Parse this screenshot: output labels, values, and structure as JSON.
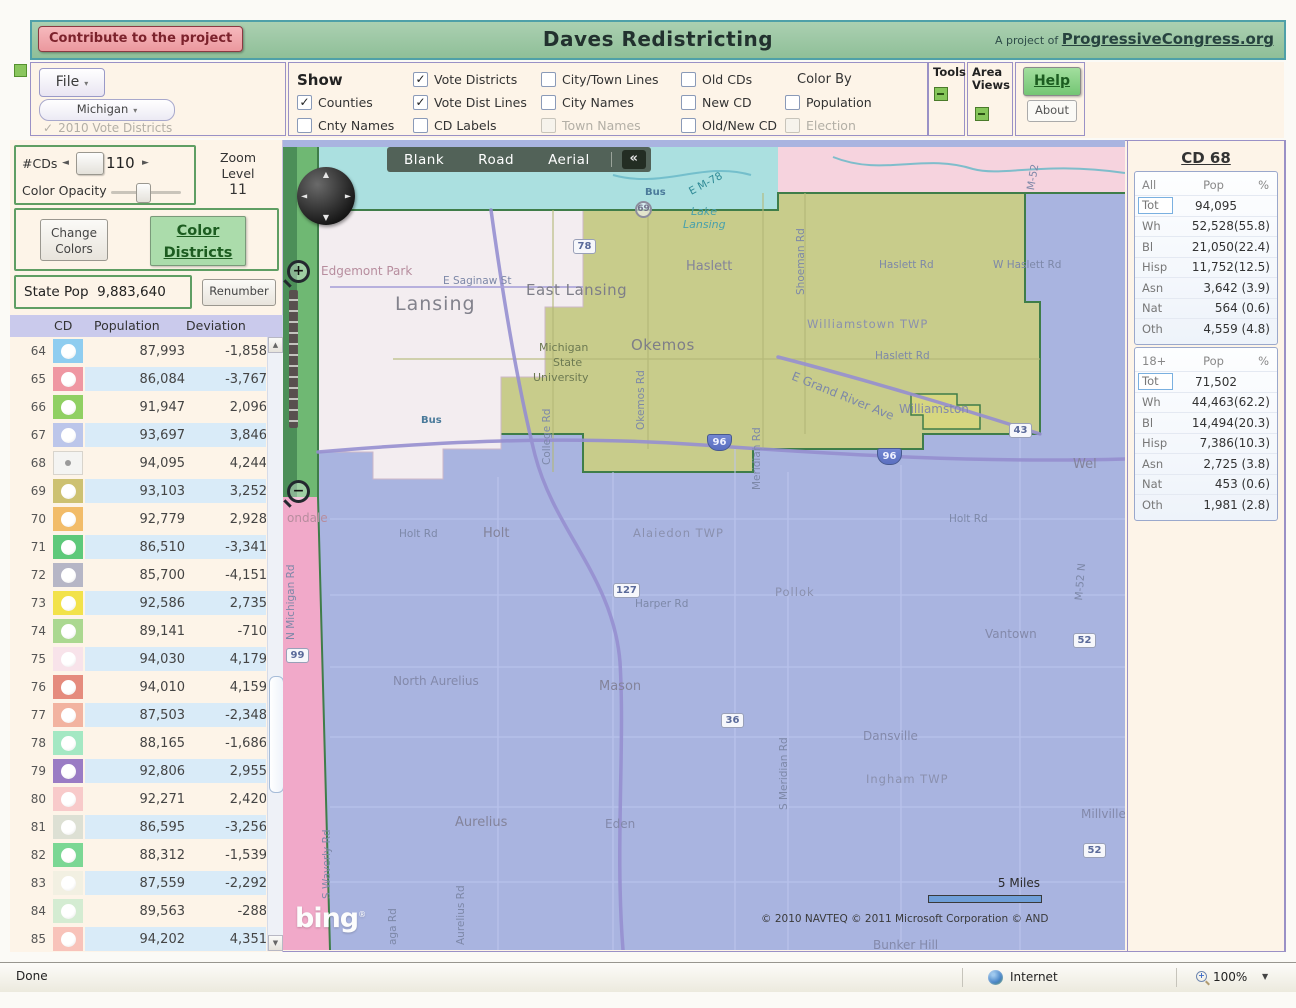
{
  "icons": {
    "caret_down": "▾",
    "check": "✓",
    "left_arrow": "◄",
    "right_arrow": "►",
    "up_arrow": "▲",
    "down_arrow": "▼",
    "collapse": "«",
    "compass_n": "▲",
    "compass_s": "▼",
    "compass_w": "◄",
    "compass_e": "►",
    "plus": "+",
    "minus": "−"
  },
  "banner": {
    "contribute_label": "Contribute to the project",
    "title": "Daves Redistricting",
    "project_prefix": "A project of",
    "project_link": "ProgressiveCongress.org"
  },
  "toolbar": {
    "file_label": "File",
    "state_label": "Michigan",
    "vote_districts_2010": "2010 Vote Districts",
    "show_columns": [
      {
        "header": "Show",
        "items": [
          {
            "label": "Counties",
            "checked": true
          },
          {
            "label": "Cnty Names"
          }
        ]
      },
      {
        "items": [
          {
            "label": "Vote Districts",
            "checked": true
          },
          {
            "label": "Vote Dist Lines",
            "checked": true
          },
          {
            "label": "CD Labels"
          }
        ]
      },
      {
        "items": [
          {
            "label": "City/Town Lines"
          },
          {
            "label": "City Names"
          },
          {
            "label": "Town Names",
            "disabled": true
          }
        ]
      },
      {
        "items": [
          {
            "label": "Old CDs"
          },
          {
            "label": "New CD"
          },
          {
            "label": "Old/New CD"
          }
        ]
      },
      {
        "header": "Color By",
        "header_plain": true,
        "items": [
          {
            "label": "Population"
          },
          {
            "label": "Election",
            "disabled": true
          }
        ]
      }
    ],
    "tools_label": "Tools",
    "area_views_label_1": "Area",
    "area_views_label_2": "Views",
    "help_label": "Help",
    "about_label": "About"
  },
  "sidebar": {
    "num_cds_label": "#CDs",
    "num_cds_value": "110",
    "color_opacity_label": "Color Opacity",
    "zoom_level_label": "Zoom Level",
    "zoom_level_value": "11",
    "change_colors_line1": "Change",
    "change_colors_line2": "Colors",
    "color_districts_line1": "Color",
    "color_districts_line2": "Districts",
    "state_pop_label": "State Pop",
    "state_pop_value": "9,883,640",
    "renumber_label": "Renumber",
    "table": {
      "headers": [
        "CD",
        "Population",
        "Deviation"
      ],
      "rows": [
        {
          "cd": "64",
          "color": "#8fcdf0",
          "pop": "87,993",
          "dev": "-1,858"
        },
        {
          "cd": "65",
          "color": "#ef97a2",
          "pop": "86,084",
          "dev": "-3,767"
        },
        {
          "cd": "66",
          "color": "#90d063",
          "pop": "91,947",
          "dev": "2,096"
        },
        {
          "cd": "67",
          "color": "#bcc6ea",
          "pop": "93,697",
          "dev": "3,846"
        },
        {
          "cd": "68",
          "color": "#f4f4f2",
          "pop": "94,095",
          "dev": "4,244",
          "selected": true
        },
        {
          "cd": "69",
          "color": "#cdc171",
          "pop": "93,103",
          "dev": "3,252"
        },
        {
          "cd": "70",
          "color": "#f2bc69",
          "pop": "92,779",
          "dev": "2,928"
        },
        {
          "cd": "71",
          "color": "#5ec97a",
          "pop": "86,510",
          "dev": "-3,341"
        },
        {
          "cd": "72",
          "color": "#b6b6c6",
          "pop": "85,700",
          "dev": "-4,151"
        },
        {
          "cd": "73",
          "color": "#f2e24a",
          "pop": "92,586",
          "dev": "2,735"
        },
        {
          "cd": "74",
          "color": "#abd890",
          "pop": "89,141",
          "dev": "-710"
        },
        {
          "cd": "75",
          "color": "#f8e3ea",
          "pop": "94,030",
          "dev": "4,179"
        },
        {
          "cd": "76",
          "color": "#e58b7d",
          "pop": "94,010",
          "dev": "4,159"
        },
        {
          "cd": "77",
          "color": "#f2b3a0",
          "pop": "87,503",
          "dev": "-2,348"
        },
        {
          "cd": "78",
          "color": "#a4e8c3",
          "pop": "88,165",
          "dev": "-1,686"
        },
        {
          "cd": "79",
          "color": "#9a7cc4",
          "pop": "92,806",
          "dev": "2,955"
        },
        {
          "cd": "80",
          "color": "#f8caca",
          "pop": "92,271",
          "dev": "2,420"
        },
        {
          "cd": "81",
          "color": "#dde0d4",
          "pop": "86,595",
          "dev": "-3,256"
        },
        {
          "cd": "82",
          "color": "#7bd794",
          "pop": "88,312",
          "dev": "-1,539"
        },
        {
          "cd": "83",
          "color": "#f2f0e2",
          "pop": "87,559",
          "dev": "-2,292"
        },
        {
          "cd": "84",
          "color": "#d4ecd2",
          "pop": "89,563",
          "dev": "-288"
        },
        {
          "cd": "85",
          "color": "#f8c3ba",
          "pop": "94,202",
          "dev": "4,351"
        }
      ]
    }
  },
  "map": {
    "layer_buttons": [
      "Blank",
      "Road",
      "Aerial"
    ],
    "region_colors": {
      "blue": "#a9b4e0",
      "olive": "#c8cc8b",
      "pink_top": "#f6d3de",
      "pink_left": "#f1a9c9",
      "cyan": "#abe0e0",
      "green_left": "#6fb873",
      "green_dark": "#4c8f58",
      "pale": "#f3edf0",
      "enclave": "#d6d680",
      "border": "#3f7d49"
    },
    "labels": [
      {
        "text": "Edgemont Park",
        "x": 38,
        "y": 117,
        "cls": "place"
      },
      {
        "text": "E Saginaw St",
        "x": 160,
        "y": 128,
        "cls": "road"
      },
      {
        "text": "Lansing",
        "x": 112,
        "y": 146,
        "cls": "city-lg"
      },
      {
        "text": "East Lansing",
        "x": 243,
        "y": 134,
        "cls": "city-md"
      },
      {
        "text": "Okemos",
        "x": 348,
        "y": 189,
        "cls": "city-md"
      },
      {
        "text": "Haslett",
        "x": 403,
        "y": 112,
        "cls": "city"
      },
      {
        "text": "Michigan",
        "x": 256,
        "y": 194,
        "cls": "uni"
      },
      {
        "text": "State",
        "x": 270,
        "y": 209,
        "cls": "uni"
      },
      {
        "text": "University",
        "x": 250,
        "y": 224,
        "cls": "uni"
      },
      {
        "text": "Williamstown TWP",
        "x": 524,
        "y": 170,
        "cls": "twp"
      },
      {
        "text": "E Grand River Ave",
        "x": 512,
        "y": 222,
        "cls": "road",
        "rot": 22,
        "size": 12
      },
      {
        "text": "Haslett Rd",
        "x": 592,
        "y": 203,
        "cls": "road"
      },
      {
        "text": "Haslett Rd",
        "x": 596,
        "y": 112,
        "cls": "road"
      },
      {
        "text": "W Haslett Rd",
        "x": 710,
        "y": 112,
        "cls": "road"
      },
      {
        "text": "Shoeman Rd",
        "x": 512,
        "y": 148,
        "cls": "road",
        "rot": -90
      },
      {
        "text": "M-52",
        "x": 742,
        "y": 42,
        "cls": "road",
        "rot": -80
      },
      {
        "text": "Lake",
        "x": 408,
        "y": 58,
        "cls": "water"
      },
      {
        "text": "Lansing",
        "x": 400,
        "y": 71,
        "cls": "water"
      },
      {
        "text": "E M-78",
        "x": 404,
        "y": 40,
        "cls": "teal",
        "rot": -28
      },
      {
        "text": "Bus",
        "x": 362,
        "y": 40,
        "cls": "bus"
      },
      {
        "text": "Bus",
        "x": 138,
        "y": 268,
        "cls": "bus"
      },
      {
        "text": "Okemos Rd",
        "x": 352,
        "y": 283,
        "cls": "road",
        "rot": -90
      },
      {
        "text": "College Rd",
        "x": 258,
        "y": 318,
        "cls": "road",
        "rot": -90
      },
      {
        "text": "Meridian Rd",
        "x": 468,
        "y": 343,
        "cls": "road",
        "rot": -90
      },
      {
        "text": "Williamston",
        "x": 616,
        "y": 255,
        "cls": "city-sm"
      },
      {
        "text": "Wel",
        "x": 790,
        "y": 310,
        "cls": "city"
      },
      {
        "text": "ondale",
        "x": 4,
        "y": 364,
        "cls": "place"
      },
      {
        "text": "N Michigan Rd",
        "x": 2,
        "y": 493,
        "cls": "road",
        "rot": -90
      },
      {
        "text": "Holt Rd",
        "x": 116,
        "y": 381,
        "cls": "road"
      },
      {
        "text": "Holt",
        "x": 200,
        "y": 379,
        "cls": "city"
      },
      {
        "text": "Alaiedon TWP",
        "x": 350,
        "y": 379,
        "cls": "twp"
      },
      {
        "text": "Pollok",
        "x": 492,
        "y": 438,
        "cls": "twp"
      },
      {
        "text": "Holt Rd",
        "x": 666,
        "y": 366,
        "cls": "road"
      },
      {
        "text": "Harper Rd",
        "x": 352,
        "y": 451,
        "cls": "road"
      },
      {
        "text": "Vantown",
        "x": 702,
        "y": 480,
        "cls": "city-sm"
      },
      {
        "text": "M-52 N",
        "x": 790,
        "y": 453,
        "cls": "road",
        "rot": -85
      },
      {
        "text": "North Aurelius",
        "x": 110,
        "y": 527,
        "cls": "city-sm"
      },
      {
        "text": "Mason",
        "x": 316,
        "y": 532,
        "cls": "city"
      },
      {
        "text": "Dansville",
        "x": 580,
        "y": 582,
        "cls": "city-sm"
      },
      {
        "text": "Ingham TWP",
        "x": 583,
        "y": 625,
        "cls": "twp"
      },
      {
        "text": "S Meridian Rd",
        "x": 495,
        "y": 663,
        "cls": "road",
        "rot": -90
      },
      {
        "text": "Aurelius",
        "x": 172,
        "y": 668,
        "cls": "city"
      },
      {
        "text": "Eden",
        "x": 322,
        "y": 670,
        "cls": "city-sm"
      },
      {
        "text": "Millville",
        "x": 798,
        "y": 660,
        "cls": "city-sm"
      },
      {
        "text": "Bunker Hill",
        "x": 590,
        "y": 791,
        "cls": "city-sm"
      },
      {
        "text": "Aurelius Rd",
        "x": 172,
        "y": 798,
        "cls": "road",
        "rot": -90
      },
      {
        "text": "aga Rd",
        "x": 104,
        "y": 798,
        "cls": "road",
        "rot": -90
      },
      {
        "text": "S Waverly Rd",
        "x": 38,
        "y": 752,
        "cls": "road",
        "rot": -90
      }
    ],
    "shields": [
      {
        "n": "69",
        "x": 352,
        "y": 54,
        "type": "circ"
      },
      {
        "n": "78",
        "x": 290,
        "y": 92,
        "type": "sq"
      },
      {
        "n": "96",
        "x": 424,
        "y": 287,
        "type": "int"
      },
      {
        "n": "96",
        "x": 594,
        "y": 301,
        "type": "int"
      },
      {
        "n": "43",
        "x": 726,
        "y": 276,
        "type": "sq"
      },
      {
        "n": "127",
        "x": 330,
        "y": 436,
        "type": "sq"
      },
      {
        "n": "99",
        "x": 3,
        "y": 501,
        "type": "sq"
      },
      {
        "n": "36",
        "x": 438,
        "y": 566,
        "type": "sq"
      },
      {
        "n": "52",
        "x": 790,
        "y": 486,
        "type": "sq"
      },
      {
        "n": "52",
        "x": 800,
        "y": 696,
        "type": "sq"
      }
    ],
    "bing_label": "bing",
    "bing_tm": "®",
    "scale_label": "5 Miles",
    "copyright": "© 2010 NAVTEQ   © 2011 Microsoft Corporation   © AND"
  },
  "cd_panel": {
    "title": "CD 68",
    "sections": [
      {
        "header": "All",
        "col_pop": "Pop",
        "col_pct": "%",
        "rows": [
          {
            "label": "Tot",
            "value": "94,095",
            "focus": true,
            "tot": true
          },
          {
            "label": "Wh",
            "value": "52,528(55.8)"
          },
          {
            "label": "Bl",
            "value": "21,050(22.4)"
          },
          {
            "label": "Hisp",
            "value": "11,752(12.5)"
          },
          {
            "label": "Asn",
            "value": "3,642 (3.9)"
          },
          {
            "label": "Nat",
            "value": "564 (0.6)"
          },
          {
            "label": "Oth",
            "value": "4,559 (4.8)"
          }
        ]
      },
      {
        "header": "18+",
        "col_pop": "Pop",
        "col_pct": "%",
        "rows": [
          {
            "label": "Tot",
            "value": "71,502",
            "focus": true,
            "tot": true
          },
          {
            "label": "Wh",
            "value": "44,463(62.2)"
          },
          {
            "label": "Bl",
            "value": "14,494(20.3)"
          },
          {
            "label": "Hisp",
            "value": "7,386(10.3)"
          },
          {
            "label": "Asn",
            "value": "2,725 (3.8)"
          },
          {
            "label": "Nat",
            "value": "453 (0.6)"
          },
          {
            "label": "Oth",
            "value": "1,981 (2.8)"
          }
        ]
      }
    ]
  },
  "statusbar": {
    "status": "Done",
    "zone": "Internet",
    "zoom": "100%"
  }
}
